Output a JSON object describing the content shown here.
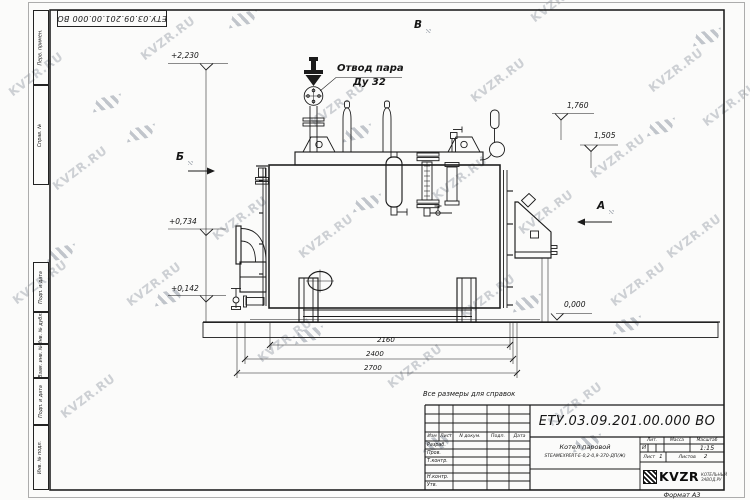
{
  "watermark": {
    "text": "KVZR.RU"
  },
  "frame": {
    "top_doc_number": "ЕТУ.03.09.201.00.000  ВО",
    "margin_labels": [
      "Перв. примен.",
      "Справ. №",
      "Подп. и дата",
      "Инв. № дубл.",
      "Взам. инв. №",
      "Подп. и дата",
      "Инв. № подл."
    ],
    "format_note": "Формат А3"
  },
  "drawing": {
    "steam_outlet": {
      "line1": "Отвод пара",
      "line2": "Ду 32"
    },
    "views": {
      "left": "Б",
      "top": "В",
      "right": "А"
    },
    "elevations": {
      "valve_top": "+2,230",
      "burner_axis": "+0,734",
      "drain": "+0,142",
      "sensor_top": "1,760",
      "bracket_top": "1,505",
      "ground": "0,000"
    },
    "dimensions": {
      "inner": "2160",
      "middle": "2400",
      "overall": "2700"
    },
    "note": "Все размеры для справок"
  },
  "title_block": {
    "doc_number": "ЕТУ.03.09.201.00.000  ВО",
    "product": {
      "line1": "Котел паровой",
      "line2": "STEAMEXPERT-Е-0,2-0,9-370-ДП(Ж)"
    },
    "rev_header": [
      "Изм",
      "Лист",
      "N докум.",
      "Подп.",
      "Дата"
    ],
    "signature_rows": [
      "Разраб.",
      "Пров.",
      "Т.контр.",
      "Н.контр.",
      "Утв."
    ],
    "lit": {
      "label": "Лит.",
      "value": "И"
    },
    "mass": {
      "label": "Масса"
    },
    "scale": {
      "label": "Масштаб",
      "value": "1:15"
    },
    "sheet": {
      "label": "Лист",
      "value": "1"
    },
    "sheets": {
      "label": "Листов",
      "value": "2"
    },
    "company": {
      "name": "KVZR",
      "sub1": "КОТЕЛЬНЫЙ",
      "sub2": "ЗАВОД.РУ"
    }
  }
}
